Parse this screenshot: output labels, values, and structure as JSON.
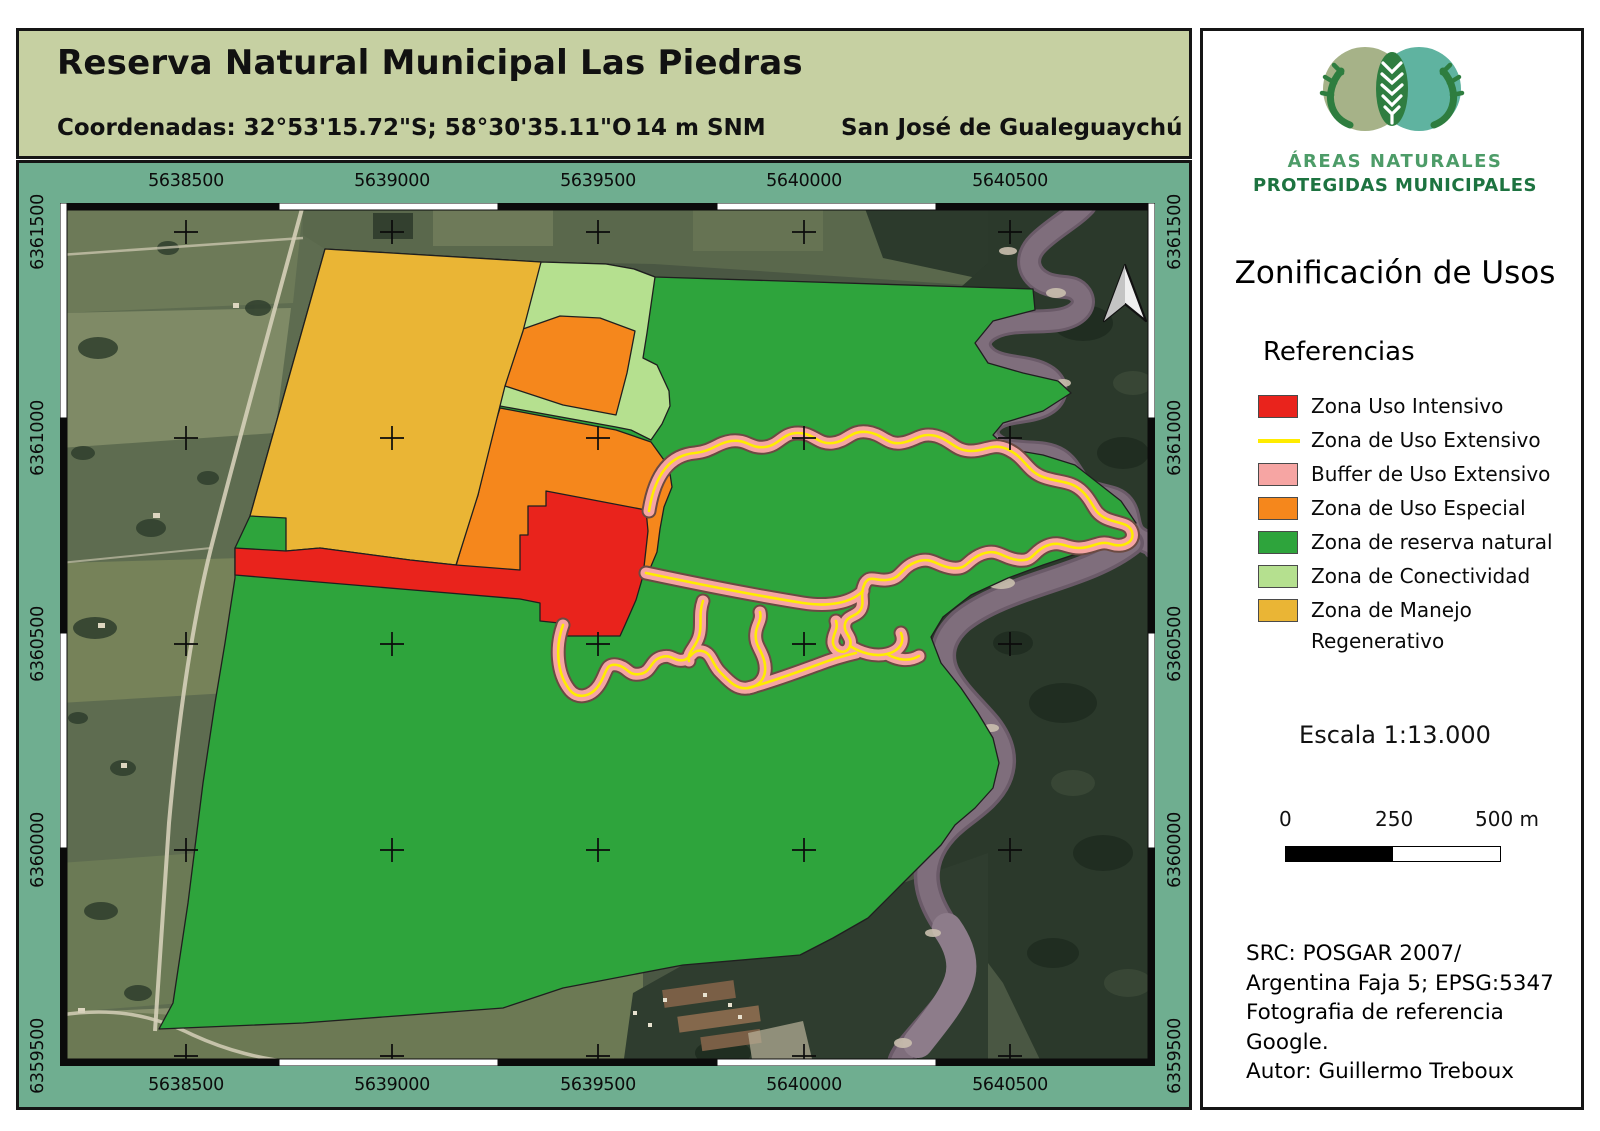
{
  "header": {
    "title": "Reserva Natural Municipal Las Piedras",
    "coordinates": "Coordenadas:  32°53'15.72\"S;  58°30'35.11\"O",
    "elevation": "14 m SNM",
    "city": "San José de Gualeguaychú"
  },
  "map": {
    "grid_x": [
      "5638500",
      "5639000",
      "5639500",
      "5640000",
      "5640500"
    ],
    "grid_y": [
      "6361500",
      "6361000",
      "6360500",
      "6360000",
      "6359500"
    ]
  },
  "zones": {
    "intensivo": "#e9231c",
    "extensivo_line": "#ffec00",
    "buffer": "#f6a5a3",
    "especial": "#f5871c",
    "reserva": "#2ea43c",
    "conectividad": "#b5e08f",
    "manejo": "#eab535"
  },
  "sidebar": {
    "logo": {
      "line1": "ÁREAS NATURALES",
      "line2": "PROTEGIDAS MUNICIPALES"
    },
    "title": "Zonificación de Usos",
    "references_heading": "Referencias",
    "legend": [
      {
        "label": "Zona Uso Intensivo",
        "key": "intensivo",
        "type": "box"
      },
      {
        "label": "Zona de Uso Extensivo",
        "key": "extensivo_line",
        "type": "line"
      },
      {
        "label": "Buffer de Uso Extensivo",
        "key": "buffer",
        "type": "box"
      },
      {
        "label": "Zona de Uso Especial",
        "key": "especial",
        "type": "box"
      },
      {
        "label": "Zona de reserva natural",
        "key": "reserva",
        "type": "box"
      },
      {
        "label": "Zona de Conectividad",
        "key": "conectividad",
        "type": "box"
      },
      {
        "label": "Zona de Manejo",
        "key": "manejo",
        "type": "box",
        "label2": "Regenerativo"
      }
    ],
    "scale_text": "Escala 1:13.000",
    "scalebar": {
      "start": "0",
      "mid": "250",
      "end": "500 m"
    },
    "attribution": [
      "SRC: POSGAR 2007/",
      "Argentina Faja 5; EPSG:5347",
      "Fotografia de referencia",
      "Google.",
      "Autor: Guillermo Treboux"
    ]
  }
}
